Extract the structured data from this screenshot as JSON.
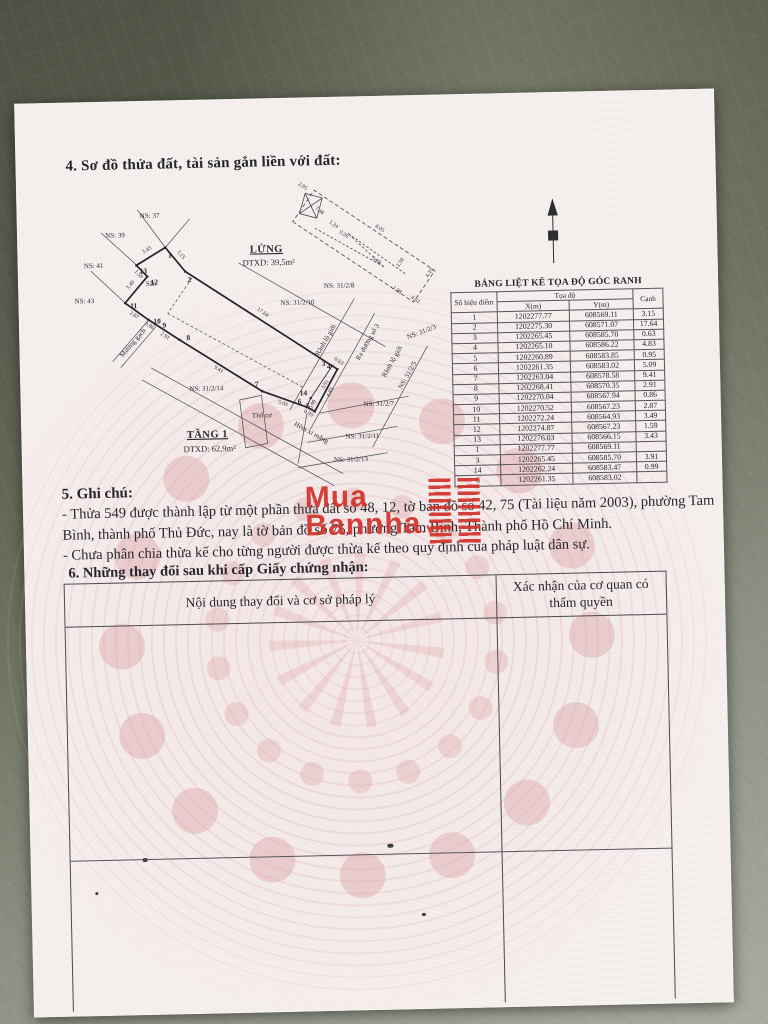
{
  "page": {
    "section4_title": "4. Sơ đồ thửa đất, tài sản gắn liền với đất:",
    "section5": {
      "title": "5. Ghi chú:",
      "line1": "- Thửa 549 được thành lập từ một phần thửa đất số 48, 12, tờ bản đồ số 42, 75 (Tài liệu năm 2003), phường Tam Bình, thành phố Thủ Đức, nay là tờ bản đồ số 75, phường Tam Bình, Thành phố Hồ Chí Minh.",
      "line2": "- Chưa phân chia thừa kế cho từng người được thừa kế theo quy định của pháp luật dân sự."
    },
    "section6": {
      "title": "6. Những thay đổi sau khi cấp Giấy chứng nhận:",
      "col1": "Nội dung thay đổi và cơ sở pháp lý",
      "col2": "Xác nhận của cơ quan có thẩm quyền"
    }
  },
  "watermark": {
    "line1": "Mua",
    "line2": "Bannha",
    "suffix": ".vn",
    "color": "#d0342c"
  },
  "diagram": {
    "lung_name": "LỬNG",
    "lung_area": "DTXD: 39,5m²",
    "tang1_name": "TẦNG 1",
    "tang1_area": "DTXD: 62,9m²",
    "labels": [
      "NS: 37",
      "NS: 39",
      "NS: 41",
      "NS: 43",
      "Sân",
      "Mương gạch",
      "NS: 31/2/8",
      "NS: 31/2/10",
      "Rãnh lộ giới",
      "Ra đường số 3",
      "NS: 31/2/3",
      "Rãnh lộ giới",
      "NS: 31/2/5",
      "NS: 31/2/14",
      "Thổ cư",
      "NS: 31/2/7",
      "NS: 31/2/11",
      "NS: 31/2/13",
      "Hẻm xi măng"
    ],
    "lung_dims": [
      "2.05",
      "7.48",
      "1.24",
      "0.26",
      "8.05",
      "5.02",
      "2.50",
      "1.98",
      "4.02",
      "4.10"
    ]
  },
  "coord_table": {
    "title": "BẢNG LIỆT KÊ TỌA ĐỘ GÓC RANH",
    "headers": {
      "point": "Số hiệu điểm",
      "group": "Tọa độ",
      "x": "X(m)",
      "y": "Y(m)",
      "edge": "Cạnh"
    },
    "block1": [
      {
        "d": "1",
        "x": "1202277.77",
        "y": "608569.11",
        "c": "3.15"
      },
      {
        "d": "2",
        "x": "1202275.30",
        "y": "608571.07",
        "c": "17.64"
      },
      {
        "d": "3",
        "x": "1202265.45",
        "y": "608585.70",
        "c": "0.63"
      },
      {
        "d": "4",
        "x": "1202265.10",
        "y": "608586.22",
        "c": "4.83"
      },
      {
        "d": "5",
        "x": "1202260.89",
        "y": "608583.85",
        "c": "0.95"
      },
      {
        "d": "6",
        "x": "1202261.35",
        "y": "608583.02",
        "c": "5.09"
      },
      {
        "d": "7",
        "x": "1202263.04",
        "y": "608578.58",
        "c": "9.41"
      },
      {
        "d": "8",
        "x": "1202268.41",
        "y": "608570.35",
        "c": "2.91"
      },
      {
        "d": "9",
        "x": "1202270.04",
        "y": "608567.94",
        "c": "0.86"
      },
      {
        "d": "10",
        "x": "1202270.52",
        "y": "608567.23",
        "c": "2.87"
      },
      {
        "d": "11",
        "x": "1202272.24",
        "y": "608564.93",
        "c": "3.49"
      },
      {
        "d": "12",
        "x": "1202274.87",
        "y": "608567.23",
        "c": "1.59"
      },
      {
        "d": "13",
        "x": "1202276.03",
        "y": "608566.15",
        "c": "3.43"
      },
      {
        "d": "1",
        "x": "1202277.77",
        "y": "608569.11",
        "c": ""
      }
    ],
    "block2": [
      {
        "d": "3",
        "x": "1202265.45",
        "y": "608585.70",
        "c": "3.91"
      },
      {
        "d": "14",
        "x": "1202262.24",
        "y": "608583.47",
        "c": "0.99"
      },
      {
        "d": "6",
        "x": "1202261.35",
        "y": "608583.02",
        "c": ""
      }
    ]
  }
}
